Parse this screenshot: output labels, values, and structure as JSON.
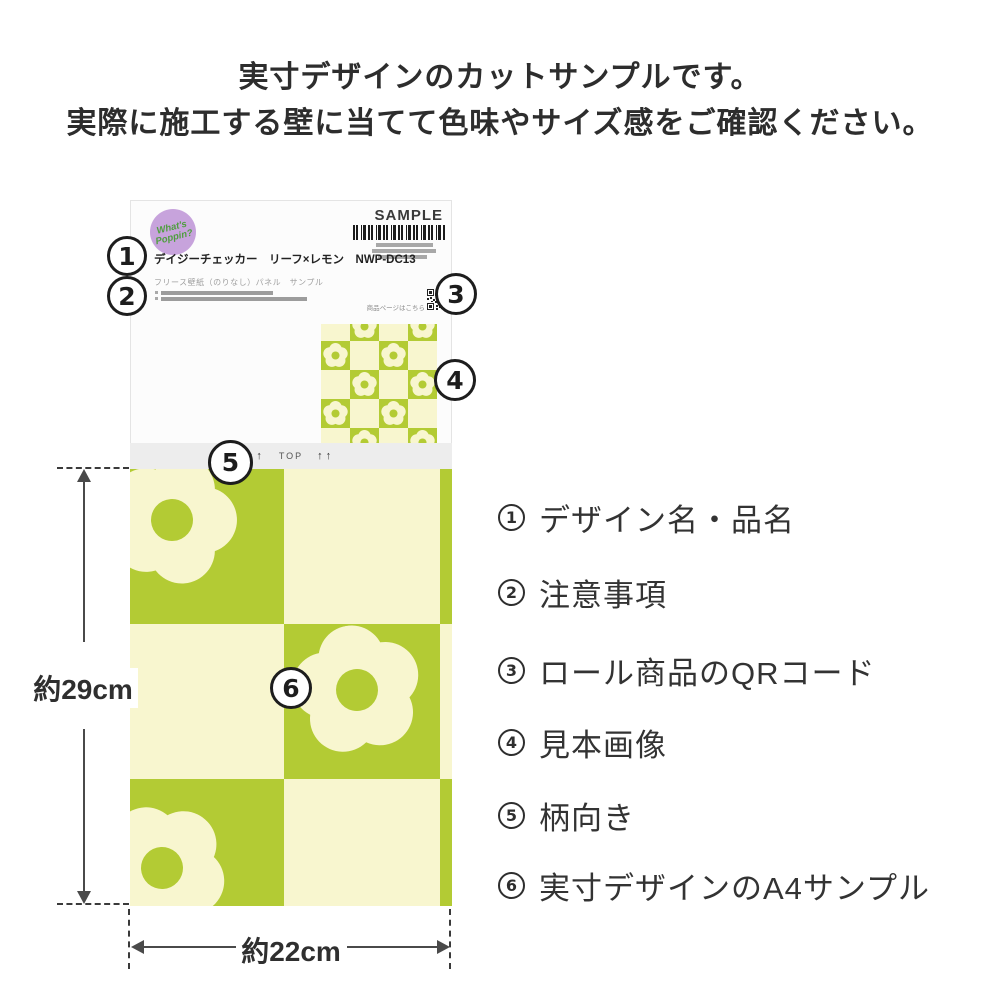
{
  "header": {
    "line1": "実寸デザインのカットサンプルです。",
    "line2": "実際に施工する壁に当てて色味やサイズ感をご確認ください。"
  },
  "sample_card": {
    "badge": {
      "line1": "What's",
      "line2": "Poppin?"
    },
    "sample_label": "SAMPLE",
    "product_title": "デイジーチェッカー　リーフ×レモン　NWP-DC13",
    "product_subtitle": "フリース壁紙（のりなし）パネル　サンプル",
    "qr_caption": "商品ページはこちら",
    "orientation": {
      "left_arrows": "↑↑",
      "label": "TOP",
      "right_arrows": "↑↑"
    }
  },
  "callouts": [
    "1",
    "2",
    "3",
    "4",
    "5",
    "6"
  ],
  "legend": {
    "items": [
      {
        "number": "1",
        "label": "デザイン名・品名"
      },
      {
        "number": "2",
        "label": "注意事項"
      },
      {
        "number": "3",
        "label": "ロール商品のQRコード"
      },
      {
        "number": "4",
        "label": "見本画像"
      },
      {
        "number": "5",
        "label": "柄向き"
      },
      {
        "number": "6",
        "label": "実寸デザインのA4サンプル"
      }
    ]
  },
  "dimensions": {
    "height_label": "約29cm",
    "width_label": "約22cm"
  },
  "colors": {
    "green": "#b3cb34",
    "cream": "#f8f6cf",
    "badge_purple": "#c7a3dc",
    "badge_green": "#4f9e3f"
  }
}
